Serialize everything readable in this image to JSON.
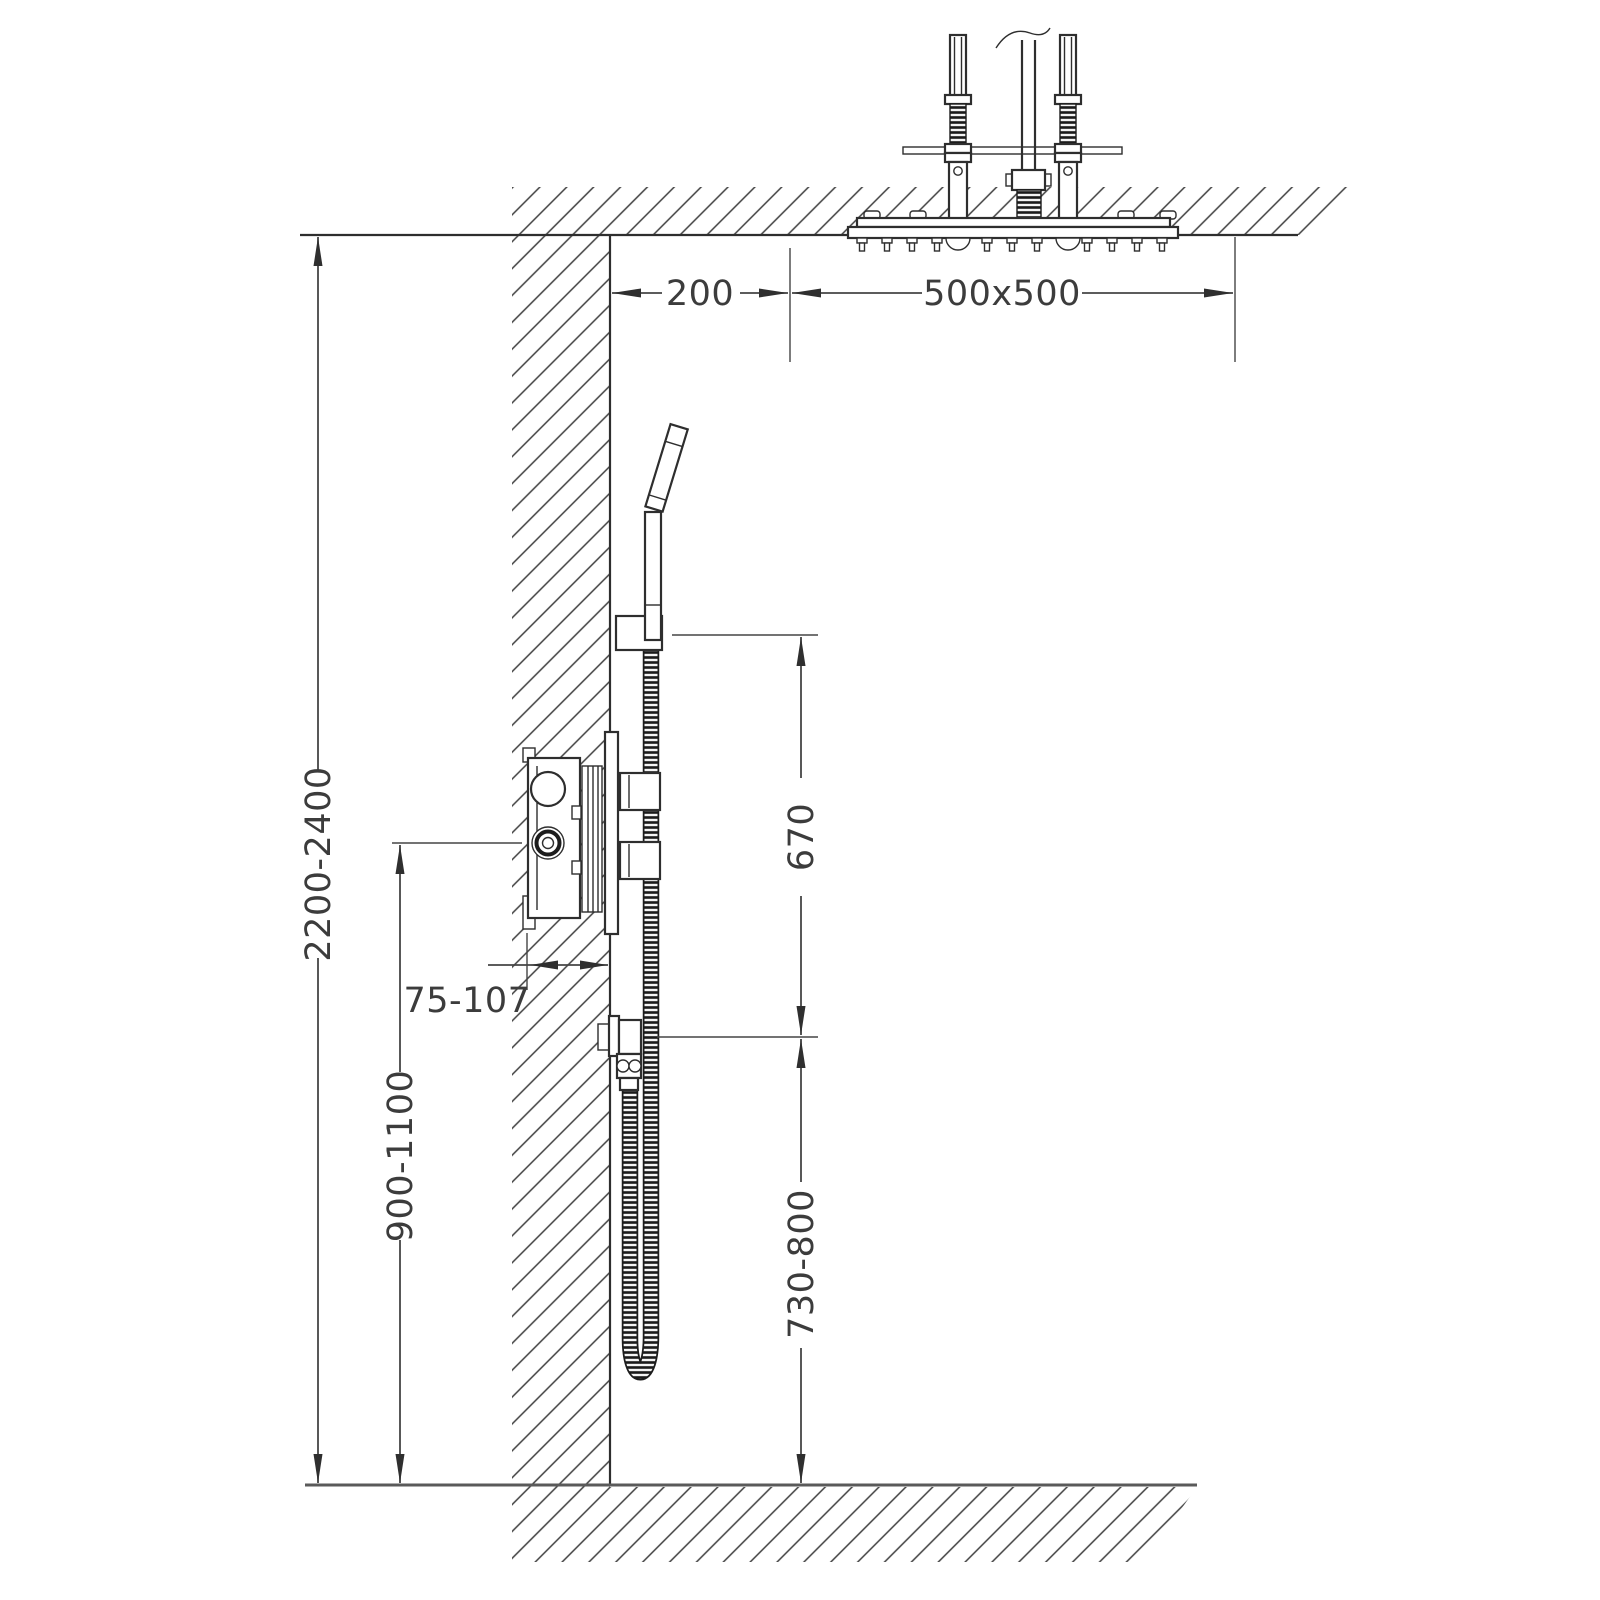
{
  "drawing": {
    "dimensions": {
      "ceiling_to_floor": "2200-2400",
      "valve_center_height": "900-1100",
      "wall_to_head": "200",
      "head_size": "500x500",
      "holder_to_outlet": "670",
      "outlet_to_floor": "730-800",
      "valve_recess_depth": "75-107"
    },
    "colors": {
      "background": "#ffffff",
      "line": "#2e2e2e",
      "dimension": "#454545",
      "hatch": "#3f3f3f",
      "text": "#3c3c3c"
    }
  }
}
